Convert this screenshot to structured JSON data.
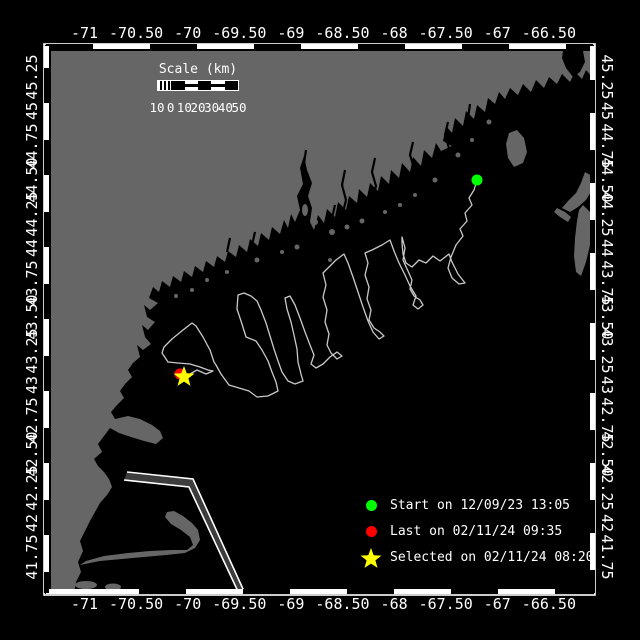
{
  "figure": {
    "kind": "drifter-track-map",
    "background": "#000000",
    "land_color": "#666666",
    "sea_color": "#000000",
    "track_color": "#c9c9c9",
    "frame_color": "#ffffff"
  },
  "axes": {
    "lon_ticks": [
      {
        "label": "-71",
        "value": -71.0
      },
      {
        "label": "-70.50",
        "value": -70.5
      },
      {
        "label": "-70",
        "value": -70.0
      },
      {
        "label": "-69.50",
        "value": -69.5
      },
      {
        "label": "-69",
        "value": -69.0
      },
      {
        "label": "-68.50",
        "value": -68.5
      },
      {
        "label": "-68",
        "value": -68.0
      },
      {
        "label": "-67.50",
        "value": -67.5
      },
      {
        "label": "-67",
        "value": -67.0
      },
      {
        "label": "-66.50",
        "value": -66.5
      }
    ],
    "lat_ticks": [
      {
        "label": "45.25",
        "value": 45.25
      },
      {
        "label": "45",
        "value": 45.0
      },
      {
        "label": "44.75",
        "value": 44.75
      },
      {
        "label": "44.50",
        "value": 44.5
      },
      {
        "label": "44.25",
        "value": 44.25
      },
      {
        "label": "44",
        "value": 44.0
      },
      {
        "label": "43.75",
        "value": 43.75
      },
      {
        "label": "43.50",
        "value": 43.5
      },
      {
        "label": "43.25",
        "value": 43.25
      },
      {
        "label": "43",
        "value": 43.0
      },
      {
        "label": "42.75",
        "value": 42.75
      },
      {
        "label": "42.50",
        "value": 42.5
      },
      {
        "label": "42.25",
        "value": 42.25
      },
      {
        "label": "42",
        "value": 42.0
      },
      {
        "label": "41.75",
        "value": 41.75
      }
    ]
  },
  "scale_bar": {
    "title": "Scale (km)",
    "tick_labels": [
      "10",
      "0",
      "10",
      "20",
      "30",
      "40",
      "50"
    ]
  },
  "legend": {
    "items": [
      {
        "icon": "circle",
        "color": "#00ff00",
        "label": "Start on 12/09/23 13:05"
      },
      {
        "icon": "circle",
        "color": "#ff0000",
        "label": "Last on 02/11/24 09:35"
      },
      {
        "icon": "star",
        "color": "#ffff00",
        "label": "Selected on 02/11/24 08:20"
      }
    ]
  },
  "chart_data": {
    "type": "map-track",
    "lon_range": [
      -71.32,
      -66.07
    ],
    "lat_range": [
      41.49,
      45.44
    ],
    "markers": {
      "start": {
        "color": "#00ff00",
        "shape": "circle",
        "lon": -67.2,
        "lat": 44.5,
        "px": [
          477,
          180
        ]
      },
      "last": {
        "color": "#ff0000",
        "shape": "circle",
        "lon": -70.08,
        "lat": 43.08,
        "px": [
          180,
          374
        ]
      },
      "selected": {
        "color": "#ffff00",
        "shape": "star",
        "lon": -70.04,
        "lat": 43.06,
        "px": [
          184,
          377
        ]
      }
    },
    "track": {
      "points_px": "477,180 474,190 469,198 472,205 465,213 467,221 460,229 463,236 456,245 451,257 448,268 452,278 459,284 465,283 458,274 452,262 449,254 440,261 433,256 426,263 419,260 412,267 406,263 403,254 402,243 402,237 405,248 403,260 408,271 412,280 410,289 414,296 420,300 423,305 418,309 413,305 416,296 410,286 405,275 399,263 394,251 390,240 382,245 372,250 365,253 368,263 365,275 369,287 367,299 371,310 369,320 374,328 380,332 384,336 379,339 373,332 368,321 363,307 358,292 353,277 348,263 344,254 336,260 329,267 323,273 326,285 323,297 327,310 325,322 329,334 327,345 331,353 337,359 342,356 337,352 330,357 323,364 316,368 311,364 314,355 310,345 305,332 300,318 295,305 290,296 285,298 287,309 291,322 294,335 297,349 298,362 301,374 303,381 295,384 288,381 282,372 278,361 274,349 270,336 266,323 261,310 257,301 251,296 244,293 238,295 237,309 242,324 246,337 256,341 262,350 268,361 272,372 276,382 278,391 268,396 257,397 249,391 239,388 229,385 221,374 216,365 214,362 210,350 203,337 196,326 192,323 183,330 172,339 164,347 162,353 166,359 168,362 178,363 190,364 200,367 208,370 213,371 206,374 197,370 190,374 184,377"
    }
  }
}
